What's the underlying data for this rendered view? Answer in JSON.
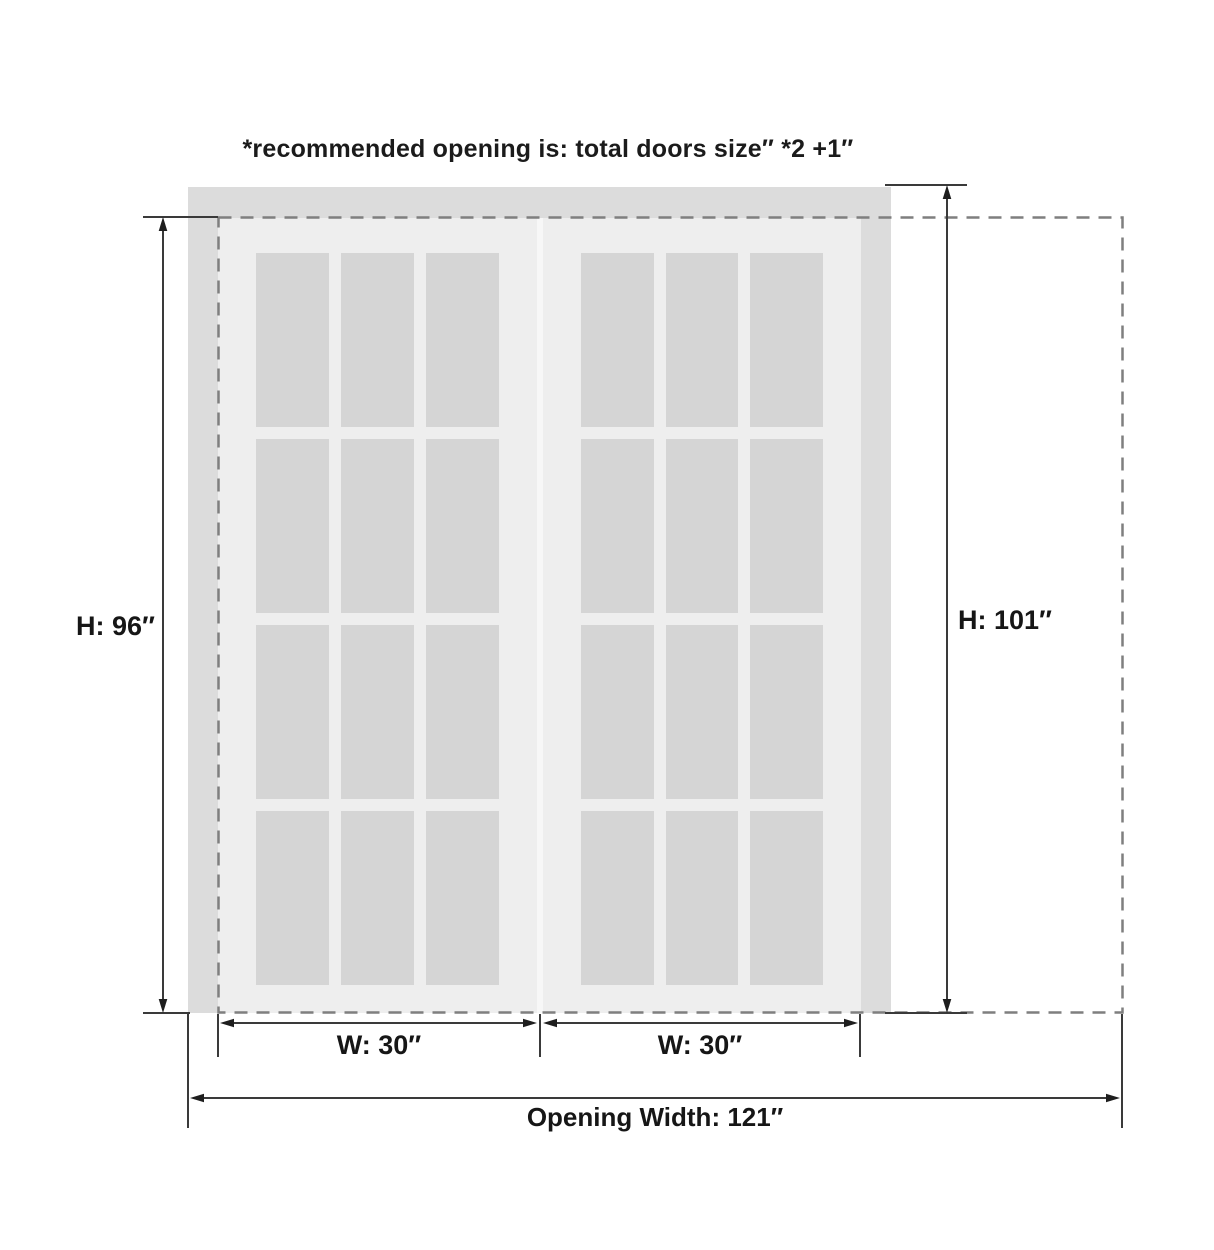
{
  "note": "*recommended opening is: total doors size″ *2 +1″",
  "dimensions": {
    "door_height": {
      "label": "H: 96″"
    },
    "opening_height": {
      "label": "H: 101″"
    },
    "door_width_left": {
      "label": "W: 30″"
    },
    "door_width_right": {
      "label": "W: 30″"
    },
    "opening_width": {
      "label": "Opening Width: 121″"
    }
  },
  "doors": {
    "count": 2,
    "panes_per_door": {
      "cols": 3,
      "rows": 4
    }
  },
  "colors": {
    "background": "#ffffff",
    "frame": "#dcdcdc",
    "door": "#eeeeee",
    "glass": "#d5d5d5",
    "divider": "#f7f7f7",
    "dashed": "#7f7f7f",
    "dimension": "#3a3a3a"
  }
}
